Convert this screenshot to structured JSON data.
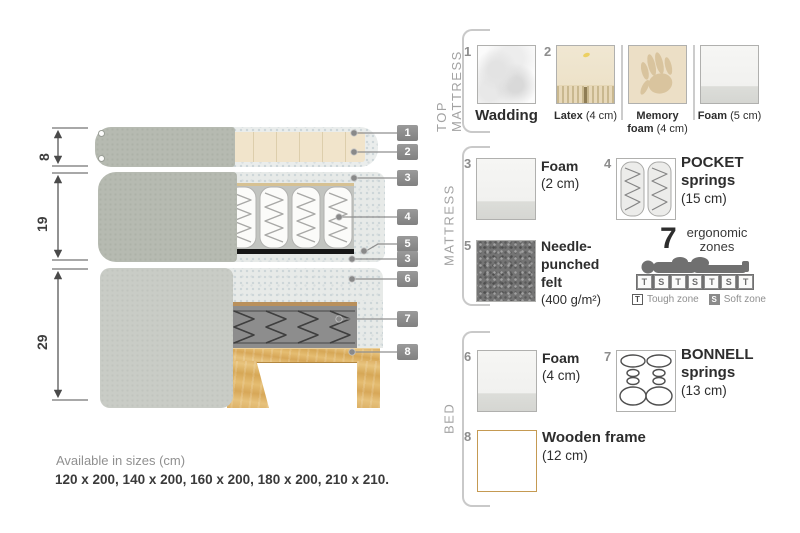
{
  "diagram": {
    "dimensions": {
      "top_mattress": "8",
      "mattress": "19",
      "bed": "29"
    },
    "callouts": [
      "1",
      "2",
      "3",
      "4",
      "5",
      "3",
      "6",
      "7",
      "8"
    ],
    "sizes": {
      "title": "Available in sizes (cm)",
      "values": "120 x 200, 140 x 200, 160 x 200, 180 x 200, 210 x 210."
    }
  },
  "legend": {
    "top_mattress": {
      "title": "TOP MATTRESS",
      "wadding": {
        "num": "1",
        "name": "Wadding"
      },
      "latex": {
        "num": "2",
        "name": "Latex",
        "size": "(4 cm)"
      },
      "memory": {
        "name": "Memory",
        "name2": "foam",
        "size": "(4 cm)"
      },
      "foam": {
        "name": "Foam",
        "size": "(5 cm)"
      }
    },
    "mattress": {
      "title": "MATTRESS",
      "foam": {
        "num": "3",
        "name": "Foam",
        "size": "(2 cm)"
      },
      "pocket": {
        "num": "4",
        "name": "POCKET",
        "name2": "springs",
        "size": "(15 cm)"
      },
      "felt": {
        "num": "5",
        "name": "Needle-",
        "name2": "punched",
        "name3": "felt",
        "size": "(400 g/m²)"
      },
      "zones": {
        "count": "7",
        "label1": "ergonomic",
        "label2": "zones",
        "pattern": [
          "T",
          "S",
          "T",
          "S",
          "T",
          "S",
          "T"
        ],
        "tough_key": "T",
        "tough_label": "Tough zone",
        "soft_key": "S",
        "soft_label": "Soft zone"
      }
    },
    "bed": {
      "title": "BED",
      "foam": {
        "num": "6",
        "name": "Foam",
        "size": "(4 cm)"
      },
      "bonnell": {
        "num": "7",
        "name": "BONNELL",
        "name2": "springs",
        "size": "(13 cm)"
      },
      "frame": {
        "num": "8",
        "name": "Wooden frame",
        "size": "(12 cm)"
      }
    }
  },
  "colors": {
    "callout_box": "#8c8c8c",
    "cover_grey": "#b6bab1",
    "bed_panel_grey": "#c9ccc6",
    "latex_cream": "#efe4cb",
    "felt_grey": "#747474",
    "bonnell_grey": "#8d8d8d",
    "wood": "#deb267"
  }
}
